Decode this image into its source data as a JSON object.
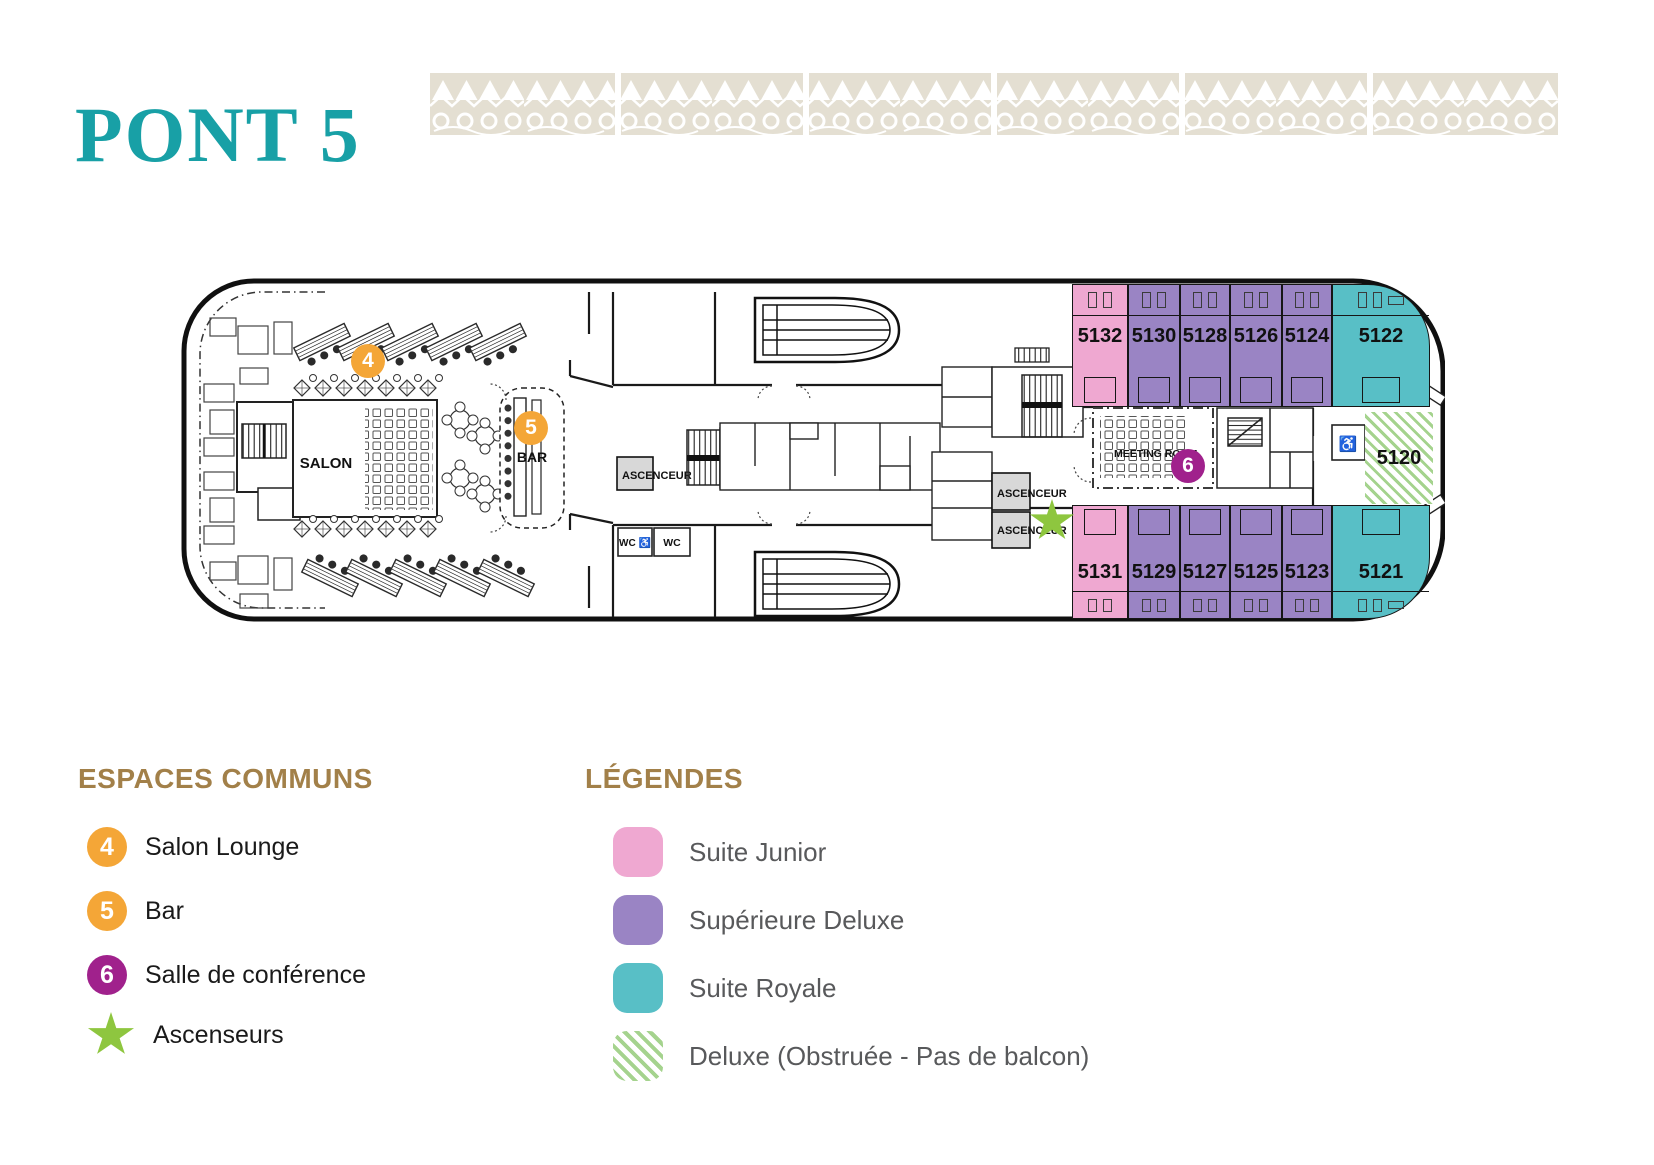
{
  "page": {
    "title": "PONT 5"
  },
  "deck_plan": {
    "badges": {
      "salon_lounge": "4",
      "bar": "5",
      "conference": "6"
    },
    "rooms": {
      "salon": "SALON",
      "bar": "BAR",
      "elevators": [
        "ASCENCEUR",
        "ASCENCEUR",
        "ASCENCEUR"
      ],
      "wc_accessible": "WC ♿",
      "wc": "WC",
      "meeting_room": "MEETING ROOM",
      "accessible_cabin_icon": "♿"
    },
    "cabins": [
      {
        "number": "5132",
        "category": "Suite Junior"
      },
      {
        "number": "5130",
        "category": "Supérieure Deluxe"
      },
      {
        "number": "5128",
        "category": "Supérieure Deluxe"
      },
      {
        "number": "5126",
        "category": "Supérieure Deluxe"
      },
      {
        "number": "5124",
        "category": "Supérieure Deluxe"
      },
      {
        "number": "5122",
        "category": "Suite Royale"
      },
      {
        "number": "5131",
        "category": "Suite Junior"
      },
      {
        "number": "5129",
        "category": "Supérieure Deluxe"
      },
      {
        "number": "5127",
        "category": "Supérieure Deluxe"
      },
      {
        "number": "5125",
        "category": "Supérieure Deluxe"
      },
      {
        "number": "5123",
        "category": "Supérieure Deluxe"
      },
      {
        "number": "5121",
        "category": "Suite Royale"
      },
      {
        "number": "5120",
        "category": "Deluxe (Obstruée - Pas de balcon)"
      }
    ]
  },
  "common_spaces": {
    "heading": "ESPACES COMMUNS",
    "items": [
      {
        "badge": "4",
        "label": "Salon Lounge"
      },
      {
        "badge": "5",
        "label": "Bar"
      },
      {
        "badge": "6",
        "label": "Salle de conférence"
      },
      {
        "badge": "star",
        "label": "Ascenseurs"
      }
    ]
  },
  "legend": {
    "heading": "LÉGENDES",
    "items": [
      {
        "label": "Suite Junior",
        "color": "#EFA8D1"
      },
      {
        "label": "Supérieure Deluxe",
        "color": "#9A84C4"
      },
      {
        "label": "Suite Royale",
        "color": "#58BFC6"
      },
      {
        "label": "Deluxe (Obstruée - Pas de balcon)",
        "color": "hatched #A5D38E"
      }
    ]
  },
  "colors": {
    "title_teal": "#18A0A6",
    "heading_gold": "#A28049",
    "badge_orange": "#F4A637",
    "badge_magenta": "#A0218C",
    "elevator_star_green": "#8EC63F",
    "pattern_beige": "#E4DFD2",
    "legend_text_gray": "#58595B"
  }
}
